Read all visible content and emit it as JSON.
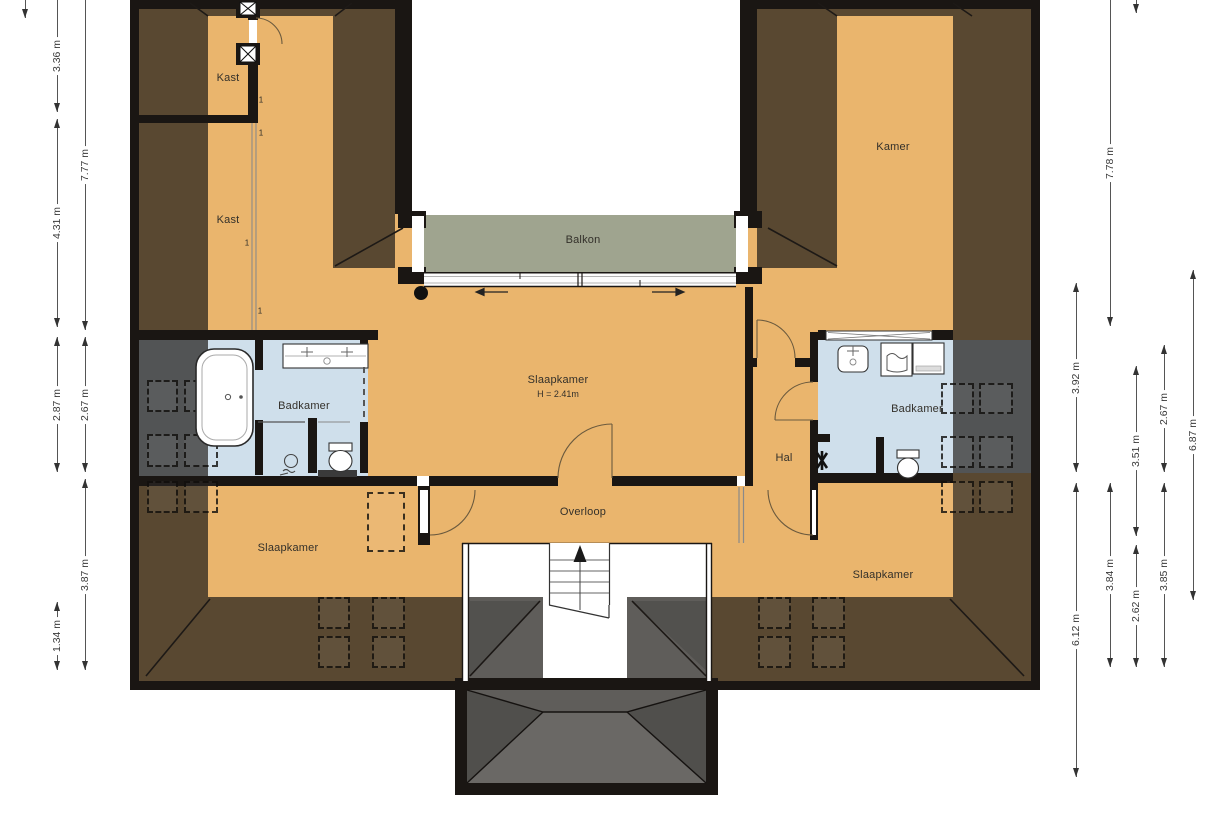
{
  "title": "Plattegrond verdieping (floor plan)",
  "colors": {
    "floor_tan": "#eab56d",
    "bathroom_blue": "#cfdfeb",
    "balcony_green": "#9fa48f",
    "wall_black": "#1a1613",
    "roof_overlay": "rgba(33,30,26,0.72)",
    "dimension_text": "#3a3a3a"
  },
  "rooms": [
    {
      "id": "kast-1",
      "label": "Kast",
      "x": 228,
      "y": 78
    },
    {
      "id": "kast-2",
      "label": "Kast",
      "x": 228,
      "y": 220
    },
    {
      "id": "kamer",
      "label": "Kamer",
      "x": 893,
      "y": 147
    },
    {
      "id": "balkon",
      "label": "Balkon",
      "x": 583,
      "y": 240
    },
    {
      "id": "slaapkamer-midden",
      "label": "Slaapkamer",
      "sublabel": "H = 2.41m",
      "x": 558,
      "y": 380,
      "suby": 394
    },
    {
      "id": "badkamer-links",
      "label": "Badkamer",
      "x": 304,
      "y": 406
    },
    {
      "id": "badkamer-rechts",
      "label": "Badkamer",
      "x": 917,
      "y": 409
    },
    {
      "id": "hal",
      "label": "Hal",
      "x": 784,
      "y": 458
    },
    {
      "id": "overloop",
      "label": "Overloop",
      "x": 583,
      "y": 512
    },
    {
      "id": "slaapkamer-links",
      "label": "Slaapkamer",
      "x": 288,
      "y": 548
    },
    {
      "id": "slaapkamer-rechts",
      "label": "Slaapkamer",
      "x": 883,
      "y": 575
    }
  ],
  "dimensions": {
    "left": [
      {
        "x": 25,
        "y1": 0,
        "y2": 18,
        "label": ""
      },
      {
        "x": 57,
        "y1": 0,
        "y2": 112,
        "label": "3.36 m"
      },
      {
        "x": 57,
        "y1": 119,
        "y2": 327,
        "label": "4.31 m"
      },
      {
        "x": 57,
        "y1": 337,
        "y2": 472,
        "label": "2.87 m"
      },
      {
        "x": 57,
        "y1": 602,
        "y2": 670,
        "label": "1.34 m"
      },
      {
        "x": 85,
        "y1": 0,
        "y2": 330,
        "label": "7.77 m"
      },
      {
        "x": 85,
        "y1": 337,
        "y2": 472,
        "label": "2.67 m"
      },
      {
        "x": 85,
        "y1": 479,
        "y2": 670,
        "label": "3.87 m"
      }
    ],
    "right": [
      {
        "x": 1076,
        "y1": 283,
        "y2": 472,
        "label": "3.92 m"
      },
      {
        "x": 1076,
        "y1": 483,
        "y2": 777,
        "label": "6.12 m"
      },
      {
        "x": 1110,
        "y1": 0,
        "y2": 326,
        "label": "7.78 m"
      },
      {
        "x": 1110,
        "y1": 483,
        "y2": 667,
        "label": "3.84 m"
      },
      {
        "x": 1136,
        "y1": 0,
        "y2": 13,
        "label": ""
      },
      {
        "x": 1136,
        "y1": 366,
        "y2": 536,
        "label": "3.51 m"
      },
      {
        "x": 1136,
        "y1": 545,
        "y2": 667,
        "label": "2.62 m"
      },
      {
        "x": 1164,
        "y1": 345,
        "y2": 472,
        "label": "2.67 m"
      },
      {
        "x": 1164,
        "y1": 483,
        "y2": 667,
        "label": "3.85 m"
      },
      {
        "x": 1193,
        "y1": 270,
        "y2": 600,
        "label": "6.87 m"
      }
    ]
  },
  "annotations": [
    {
      "text": "1",
      "x": 261,
      "y": 100
    },
    {
      "text": "1",
      "x": 261,
      "y": 133
    },
    {
      "text": "1",
      "x": 247,
      "y": 243
    },
    {
      "text": "1",
      "x": 260,
      "y": 311
    }
  ],
  "roof_windows": [
    {
      "x": 147,
      "y": 380,
      "w": 31,
      "h": 32
    },
    {
      "x": 184,
      "y": 380,
      "w": 34,
      "h": 32
    },
    {
      "x": 147,
      "y": 434,
      "w": 31,
      "h": 33
    },
    {
      "x": 184,
      "y": 434,
      "w": 34,
      "h": 33
    },
    {
      "x": 147,
      "y": 481,
      "w": 31,
      "h": 32
    },
    {
      "x": 184,
      "y": 481,
      "w": 34,
      "h": 32
    },
    {
      "x": 367,
      "y": 492,
      "w": 38,
      "h": 60
    },
    {
      "x": 318,
      "y": 597,
      "w": 32,
      "h": 32
    },
    {
      "x": 372,
      "y": 597,
      "w": 33,
      "h": 32
    },
    {
      "x": 318,
      "y": 636,
      "w": 32,
      "h": 32
    },
    {
      "x": 372,
      "y": 636,
      "w": 33,
      "h": 32
    },
    {
      "x": 758,
      "y": 597,
      "w": 33,
      "h": 32
    },
    {
      "x": 812,
      "y": 597,
      "w": 33,
      "h": 32
    },
    {
      "x": 758,
      "y": 636,
      "w": 33,
      "h": 32
    },
    {
      "x": 812,
      "y": 636,
      "w": 33,
      "h": 32
    },
    {
      "x": 941,
      "y": 383,
      "w": 33,
      "h": 31
    },
    {
      "x": 979,
      "y": 383,
      "w": 34,
      "h": 31
    },
    {
      "x": 941,
      "y": 436,
      "w": 33,
      "h": 32
    },
    {
      "x": 979,
      "y": 436,
      "w": 34,
      "h": 32
    },
    {
      "x": 941,
      "y": 481,
      "w": 33,
      "h": 32
    },
    {
      "x": 979,
      "y": 481,
      "w": 34,
      "h": 32
    }
  ],
  "floors": {
    "blue": [
      {
        "x": 139,
        "y": 340,
        "w": 229,
        "h": 136
      },
      {
        "x": 818,
        "y": 340,
        "w": 213,
        "h": 133
      }
    ],
    "white": [
      {
        "x": 412,
        "y": 0,
        "w": 328,
        "h": 215
      },
      {
        "x": 462,
        "y": 543,
        "w": 250,
        "h": 138
      }
    ]
  },
  "roof_zones": [
    {
      "x": 139,
      "y": 9,
      "w": 69,
      "h": 588
    },
    {
      "x": 953,
      "y": 9,
      "w": 78,
      "h": 588
    },
    {
      "x": 139,
      "y": 597,
      "w": 892,
      "h": 84
    },
    {
      "x": 333,
      "y": 9,
      "w": 62,
      "h": 259
    },
    {
      "x": 757,
      "y": 9,
      "w": 80,
      "h": 259
    },
    {
      "x": 208,
      "y": 9,
      "w": 125,
      "h": 7
    },
    {
      "x": 837,
      "y": 9,
      "w": 116,
      "h": 7
    },
    {
      "x": 467,
      "y": 690,
      "w": 239,
      "h": 93
    }
  ],
  "walls": [
    {
      "x": 139,
      "y": 115,
      "w": 119,
      "h": 8
    },
    {
      "x": 248,
      "y": 16,
      "w": 10,
      "h": 4
    },
    {
      "x": 248,
      "y": 44,
      "w": 10,
      "h": 71
    },
    {
      "x": 139,
      "y": 330,
      "w": 239,
      "h": 10
    },
    {
      "x": 139,
      "y": 476,
      "w": 278,
      "h": 10
    },
    {
      "x": 429,
      "y": 476,
      "w": 129,
      "h": 10
    },
    {
      "x": 612,
      "y": 476,
      "w": 125,
      "h": 10
    },
    {
      "x": 745,
      "y": 476,
      "w": 8,
      "h": 10
    },
    {
      "x": 418,
      "y": 486,
      "w": 12,
      "h": 59
    },
    {
      "x": 745,
      "y": 287,
      "w": 8,
      "h": 189
    },
    {
      "x": 753,
      "y": 358,
      "w": 4,
      "h": 9
    },
    {
      "x": 795,
      "y": 358,
      "w": 23,
      "h": 9
    },
    {
      "x": 810,
      "y": 332,
      "w": 8,
      "h": 50
    },
    {
      "x": 810,
      "y": 420,
      "w": 8,
      "h": 120
    },
    {
      "x": 818,
      "y": 330,
      "w": 8,
      "h": 10
    },
    {
      "x": 932,
      "y": 330,
      "w": 21,
      "h": 10
    },
    {
      "x": 818,
      "y": 473,
      "w": 135,
      "h": 10
    },
    {
      "x": 876,
      "y": 437,
      "w": 8,
      "h": 46
    },
    {
      "x": 818,
      "y": 434,
      "w": 12,
      "h": 8
    },
    {
      "x": 360,
      "y": 340,
      "w": 8,
      "h": 27
    },
    {
      "x": 360,
      "y": 422,
      "w": 8,
      "h": 51
    },
    {
      "x": 308,
      "y": 418,
      "w": 9,
      "h": 55
    },
    {
      "x": 255,
      "y": 340,
      "w": 8,
      "h": 30
    },
    {
      "x": 255,
      "y": 420,
      "w": 8,
      "h": 55
    },
    {
      "x": 395,
      "y": 0,
      "w": 17,
      "h": 214
    },
    {
      "x": 740,
      "y": 0,
      "w": 17,
      "h": 214
    },
    {
      "x": 398,
      "y": 211,
      "w": 28,
      "h": 17
    },
    {
      "x": 398,
      "y": 267,
      "w": 28,
      "h": 17
    },
    {
      "x": 734,
      "y": 211,
      "w": 28,
      "h": 17
    },
    {
      "x": 734,
      "y": 267,
      "w": 28,
      "h": 17
    }
  ],
  "white_patches": [
    {
      "x": 249,
      "y": 20,
      "w": 8,
      "h": 24
    },
    {
      "x": 417,
      "y": 476,
      "w": 12,
      "h": 10
    },
    {
      "x": 420,
      "y": 490,
      "w": 8,
      "h": 43
    },
    {
      "x": 812,
      "y": 490,
      "w": 4,
      "h": 45
    },
    {
      "x": 737,
      "y": 476,
      "w": 8,
      "h": 10
    },
    {
      "x": 412,
      "y": 216,
      "w": 12,
      "h": 56
    },
    {
      "x": 736,
      "y": 216,
      "w": 12,
      "h": 56
    }
  ],
  "balcony": {
    "deck": {
      "x": 424,
      "y": 215,
      "w": 312,
      "h": 57
    },
    "slide_left": "arrow-left",
    "slide_right": "arrow-right"
  },
  "stairs": {
    "x": 549,
    "y": 543,
    "w": 61,
    "h": 62,
    "treads": [
      560,
      571,
      582,
      593
    ],
    "direction": "up"
  }
}
